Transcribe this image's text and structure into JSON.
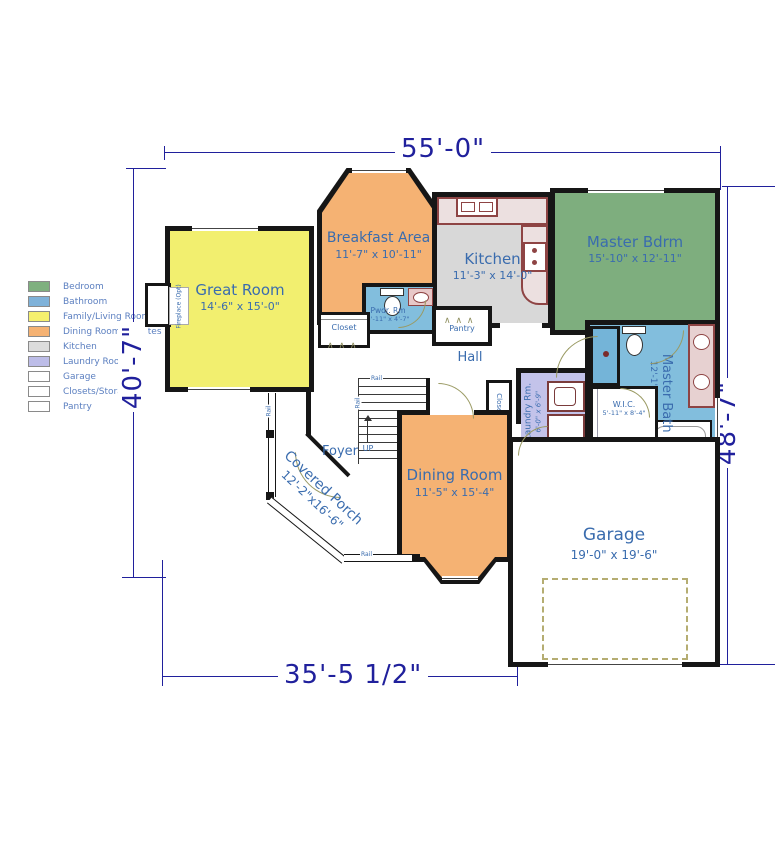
{
  "legend": {
    "items": [
      {
        "label": "Bedroom",
        "color": "#7fb07f"
      },
      {
        "label": "Bathroom",
        "color": "#7fb2d9"
      },
      {
        "label": "Family/Living Room",
        "color": "#f5f06e"
      },
      {
        "label": "Dining Room/Dinettes",
        "color": "#f5b273"
      },
      {
        "label": "Kitchen",
        "color": "#dcdcdc"
      },
      {
        "label": "Laundry Room",
        "color": "#bdbde8"
      },
      {
        "label": "Garage",
        "color": "#ffffff"
      },
      {
        "label": "Closets/Storage",
        "color": "#ffffff"
      },
      {
        "label": "Pantry",
        "color": "#ffffff"
      }
    ]
  },
  "dimensions": {
    "top": "55'-0\"",
    "left": "40'-7\"",
    "right": "48'-7\"",
    "bottom": "35'-5 1/2\""
  },
  "rooms": {
    "great_room": {
      "name": "Great Room",
      "dims": "14'-6\" x 15'-0\""
    },
    "breakfast": {
      "name": "Breakfast Area",
      "dims": "11'-7\" x 10'-11\""
    },
    "kitchen": {
      "name": "Kitchen",
      "dims": "11'-3\" x 14'-0\""
    },
    "master_bdrm": {
      "name": "Master Bdrm",
      "dims": "15'-10\" x 12'-11\""
    },
    "master_bath": {
      "name": "Master Bath",
      "dims": "12'-1\" x 12'-4\""
    },
    "wic": {
      "name": "W.I.C.",
      "dims": "5'-11\" x 8'-4\""
    },
    "laundry": {
      "name": "Laundry Rm.",
      "dims": "6'-0\" x 6'-9\""
    },
    "pwdr": {
      "name": "Pwdr. Rm",
      "dims": "5'-11\" x 4'-7\""
    },
    "dining": {
      "name": "Dining Room",
      "dims": "11'-5\" x 15'-4\""
    },
    "garage": {
      "name": "Garage",
      "dims": "19'-0\" x 19'-6\""
    },
    "porch": {
      "name": "Covered Porch",
      "dims": "12'-2\"x16'-6\""
    },
    "foyer": {
      "name": "Foyer"
    },
    "hall": {
      "name": "Hall"
    }
  },
  "labels": {
    "closet": "Closet",
    "pantry": "Pantry",
    "up": "UP",
    "rail": "Rail",
    "fireplace": "Fireplace (Opt)"
  }
}
